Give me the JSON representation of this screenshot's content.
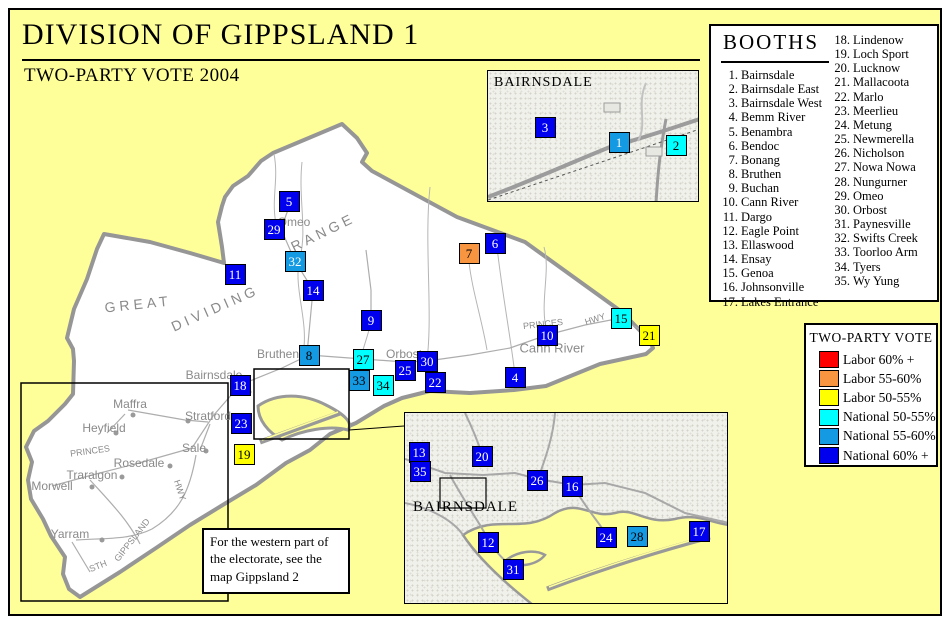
{
  "title": "DIVISION OF GIPPSLAND 1",
  "subtitle": "TWO-PARTY VOTE 2004",
  "note": {
    "text": "For the western part of the electorate, see the map Gippsland 2"
  },
  "booths_panel": {
    "title": "BOOTHS",
    "names": [
      "Bairnsdale",
      "Bairnsdale East",
      "Bairnsdale West",
      "Bemm River",
      "Benambra",
      "Bendoc",
      "Bonang",
      "Bruthen",
      "Buchan",
      "Cann River",
      "Dargo",
      "Eagle Point",
      "Ellaswood",
      "Ensay",
      "Genoa",
      "Johnsonville",
      "Lakes Entrance",
      "Lindenow",
      "Loch Sport",
      "Lucknow",
      "Mallacoota",
      "Marlo",
      "Meerlieu",
      "Metung",
      "Newmerella",
      "Nicholson",
      "Nowa Nowa",
      "Nungurner",
      "Omeo",
      "Orbost",
      "Paynesville",
      "Swifts Creek",
      "Toorloo Arm",
      "Tyers",
      "Wy Yung"
    ]
  },
  "legend": {
    "title": "TWO-PARTY VOTE",
    "items": [
      {
        "key": "lab60",
        "label": "Labor 60% +",
        "color": "#FF0000"
      },
      {
        "key": "lab55",
        "label": "Labor 55-60%",
        "color": "#F89540"
      },
      {
        "key": "lab50",
        "label": "Labor 50-55%",
        "color": "#FFFF00"
      },
      {
        "key": "nat50",
        "label": "National 50-55%",
        "color": "#00FFFF"
      },
      {
        "key": "nat55",
        "label": "National 55-60%",
        "color": "#1499E3"
      },
      {
        "key": "nat60",
        "label": "National 60% +",
        "color": "#0000EE"
      }
    ]
  },
  "insets": {
    "top": {
      "label": "BAIRNSDALE"
    },
    "bottom": {
      "label": "BAIRNSDALE"
    }
  },
  "map": {
    "booths": [
      {
        "n": 5,
        "x": 279,
        "y": 191,
        "cat": "nat60"
      },
      {
        "n": 29,
        "x": 264,
        "y": 219,
        "cat": "nat60"
      },
      {
        "n": 32,
        "x": 285,
        "y": 251,
        "cat": "nat55",
        "tc": "#FFFFFF"
      },
      {
        "n": 11,
        "x": 225,
        "y": 264,
        "cat": "nat60"
      },
      {
        "n": 14,
        "x": 303,
        "y": 280,
        "cat": "nat60"
      },
      {
        "n": 9,
        "x": 361,
        "y": 310,
        "cat": "nat60"
      },
      {
        "n": 7,
        "x": 459,
        "y": 243,
        "cat": "lab55"
      },
      {
        "n": 6,
        "x": 485,
        "y": 233,
        "cat": "nat60"
      },
      {
        "n": 15,
        "x": 611,
        "y": 308,
        "cat": "nat50"
      },
      {
        "n": 10,
        "x": 537,
        "y": 325,
        "cat": "nat60"
      },
      {
        "n": 21,
        "x": 639,
        "y": 325,
        "cat": "lab50"
      },
      {
        "n": 8,
        "x": 299,
        "y": 345,
        "cat": "nat55"
      },
      {
        "n": 27,
        "x": 353,
        "y": 349,
        "cat": "nat50"
      },
      {
        "n": 30,
        "x": 417,
        "y": 351,
        "cat": "nat60"
      },
      {
        "n": 25,
        "x": 395,
        "y": 360,
        "cat": "nat60"
      },
      {
        "n": 33,
        "x": 349,
        "y": 370,
        "cat": "nat55"
      },
      {
        "n": 34,
        "x": 373,
        "y": 375,
        "cat": "nat50"
      },
      {
        "n": 22,
        "x": 425,
        "y": 372,
        "cat": "nat60"
      },
      {
        "n": 4,
        "x": 505,
        "y": 367,
        "cat": "nat60"
      },
      {
        "n": 18,
        "x": 230,
        "y": 375,
        "cat": "nat60"
      },
      {
        "n": 23,
        "x": 231,
        "y": 413,
        "cat": "nat60"
      },
      {
        "n": 19,
        "x": 234,
        "y": 444,
        "cat": "lab50"
      },
      {
        "n": 3,
        "x": 535,
        "y": 117,
        "cat": "nat60"
      },
      {
        "n": 1,
        "x": 609,
        "y": 132,
        "cat": "nat55",
        "tc": "#FFFFFF"
      },
      {
        "n": 2,
        "x": 666,
        "y": 135,
        "cat": "nat50"
      },
      {
        "n": 13,
        "x": 409,
        "y": 442,
        "cat": "nat60"
      },
      {
        "n": 35,
        "x": 410,
        "y": 461,
        "cat": "nat60"
      },
      {
        "n": 20,
        "x": 472,
        "y": 446,
        "cat": "nat60"
      },
      {
        "n": 26,
        "x": 527,
        "y": 470,
        "cat": "nat60"
      },
      {
        "n": 16,
        "x": 562,
        "y": 476,
        "cat": "nat60"
      },
      {
        "n": 12,
        "x": 478,
        "y": 532,
        "cat": "nat60"
      },
      {
        "n": 31,
        "x": 503,
        "y": 559,
        "cat": "nat60"
      },
      {
        "n": 24,
        "x": 596,
        "y": 527,
        "cat": "nat60"
      },
      {
        "n": 28,
        "x": 627,
        "y": 526,
        "cat": "nat55"
      },
      {
        "n": 17,
        "x": 689,
        "y": 521,
        "cat": "nat60"
      }
    ],
    "labels": [
      {
        "text": "GREAT",
        "x": 128,
        "y": 294,
        "size": 14,
        "rot": -6,
        "ls": 4
      },
      {
        "text": "DIVIDING",
        "x": 205,
        "y": 298,
        "size": 14,
        "rot": -24,
        "ls": 4
      },
      {
        "text": "RANGE",
        "x": 313,
        "y": 222,
        "size": 14,
        "rot": -26,
        "ls": 4
      },
      {
        "text": "Omeo",
        "x": 284,
        "y": 212,
        "size": 12
      },
      {
        "text": "Bruthen",
        "x": 268,
        "y": 344,
        "size": 12
      },
      {
        "text": "Bairnsdale",
        "x": 204,
        "y": 365,
        "size": 12
      },
      {
        "text": "Orbost",
        "x": 394,
        "y": 344,
        "size": 12
      },
      {
        "text": "Cann River",
        "x": 542,
        "y": 338,
        "size": 13
      },
      {
        "text": "PRINCES",
        "x": 533,
        "y": 314,
        "size": 9,
        "rot": -6
      },
      {
        "text": "HWY",
        "x": 585,
        "y": 309,
        "size": 9,
        "rot": -18
      },
      {
        "text": "Maffra",
        "x": 120,
        "y": 394,
        "size": 12
      },
      {
        "text": "Stratford",
        "x": 198,
        "y": 406,
        "size": 12
      },
      {
        "text": "Heyfield",
        "x": 94,
        "y": 418,
        "size": 12
      },
      {
        "text": "Sale",
        "x": 184,
        "y": 438,
        "size": 12
      },
      {
        "text": "Rosedale",
        "x": 129,
        "y": 453,
        "size": 12
      },
      {
        "text": "Traralgon",
        "x": 82,
        "y": 465,
        "size": 12
      },
      {
        "text": "Morwell",
        "x": 42,
        "y": 476,
        "size": 12
      },
      {
        "text": "Yarram",
        "x": 60,
        "y": 524,
        "size": 12
      },
      {
        "text": "PRINCES",
        "x": 80,
        "y": 441,
        "size": 9,
        "rot": -8
      },
      {
        "text": "HWY",
        "x": 170,
        "y": 480,
        "size": 9,
        "rot": 72
      },
      {
        "text": "GIPPSLAND",
        "x": 122,
        "y": 530,
        "size": 9,
        "rot": -52
      },
      {
        "text": "STH",
        "x": 88,
        "y": 556,
        "size": 9,
        "rot": -22
      }
    ]
  }
}
